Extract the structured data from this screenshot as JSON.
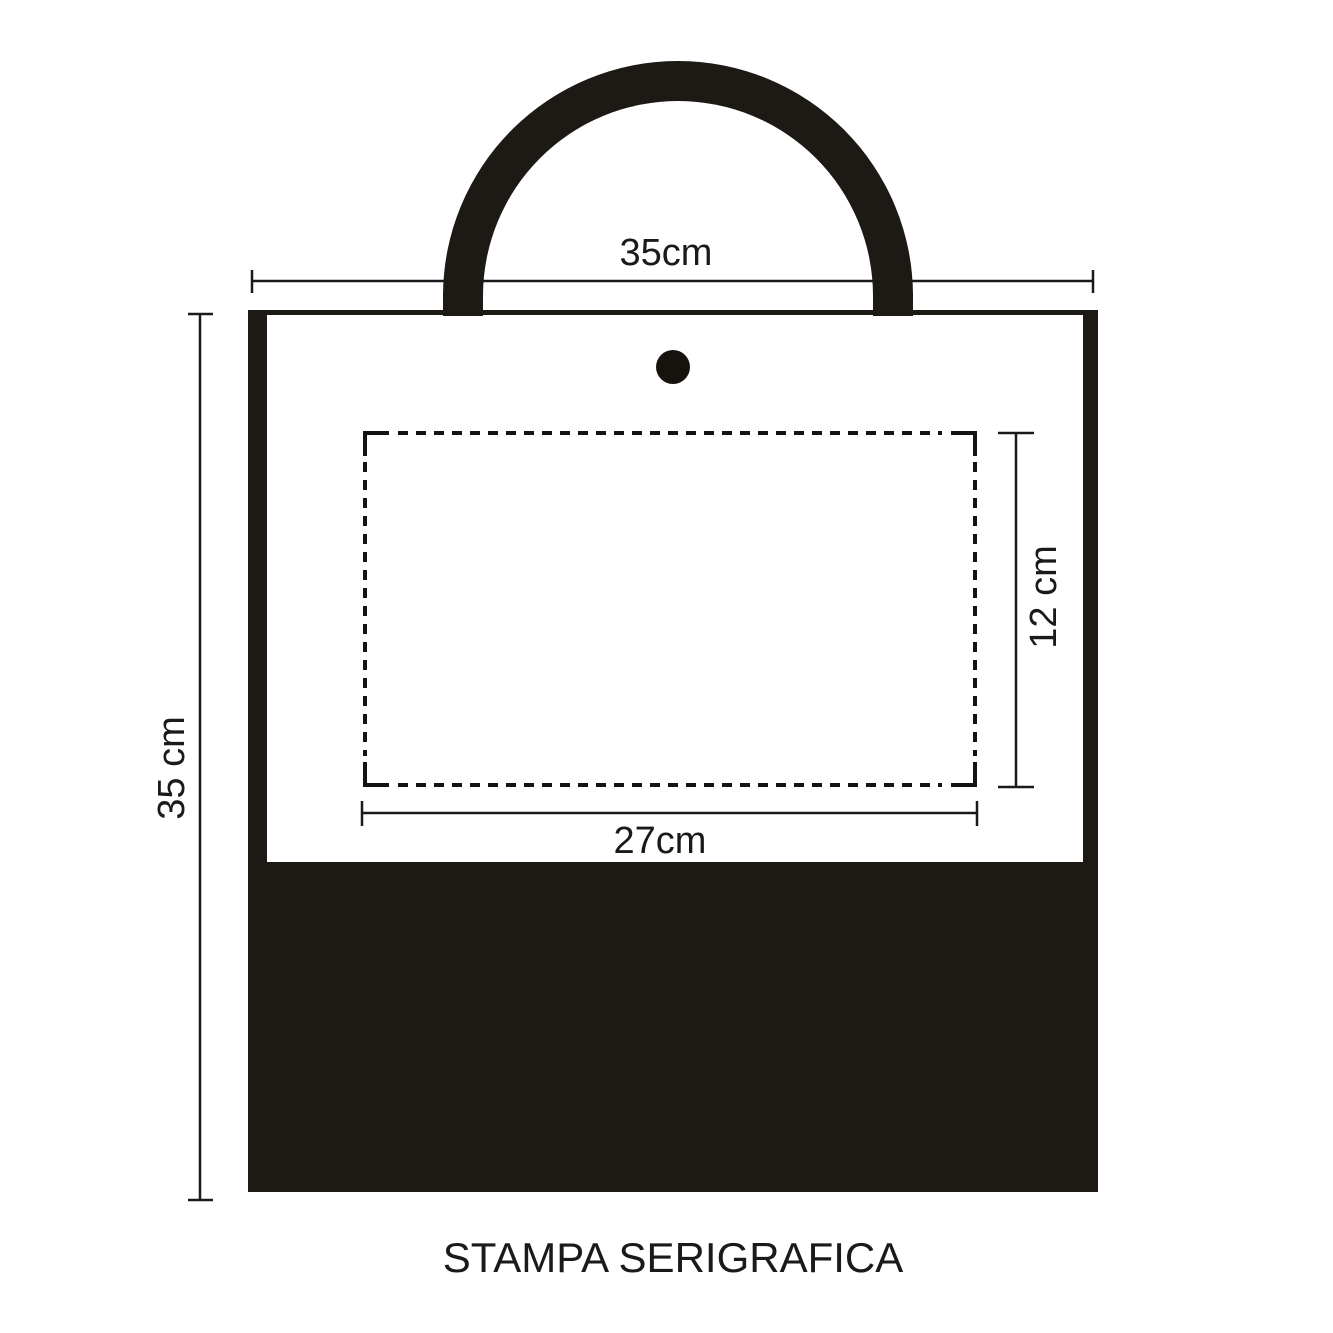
{
  "diagram": {
    "title": "STAMPA SERIGRAFICA",
    "labels": {
      "bag_width": "35cm",
      "bag_height": "35 cm",
      "print_area_width": "27cm",
      "print_area_height": "12 cm"
    },
    "colors": {
      "ink_black": "#1d1a16",
      "line_black": "#1a1a1a",
      "background": "#ffffff"
    }
  }
}
